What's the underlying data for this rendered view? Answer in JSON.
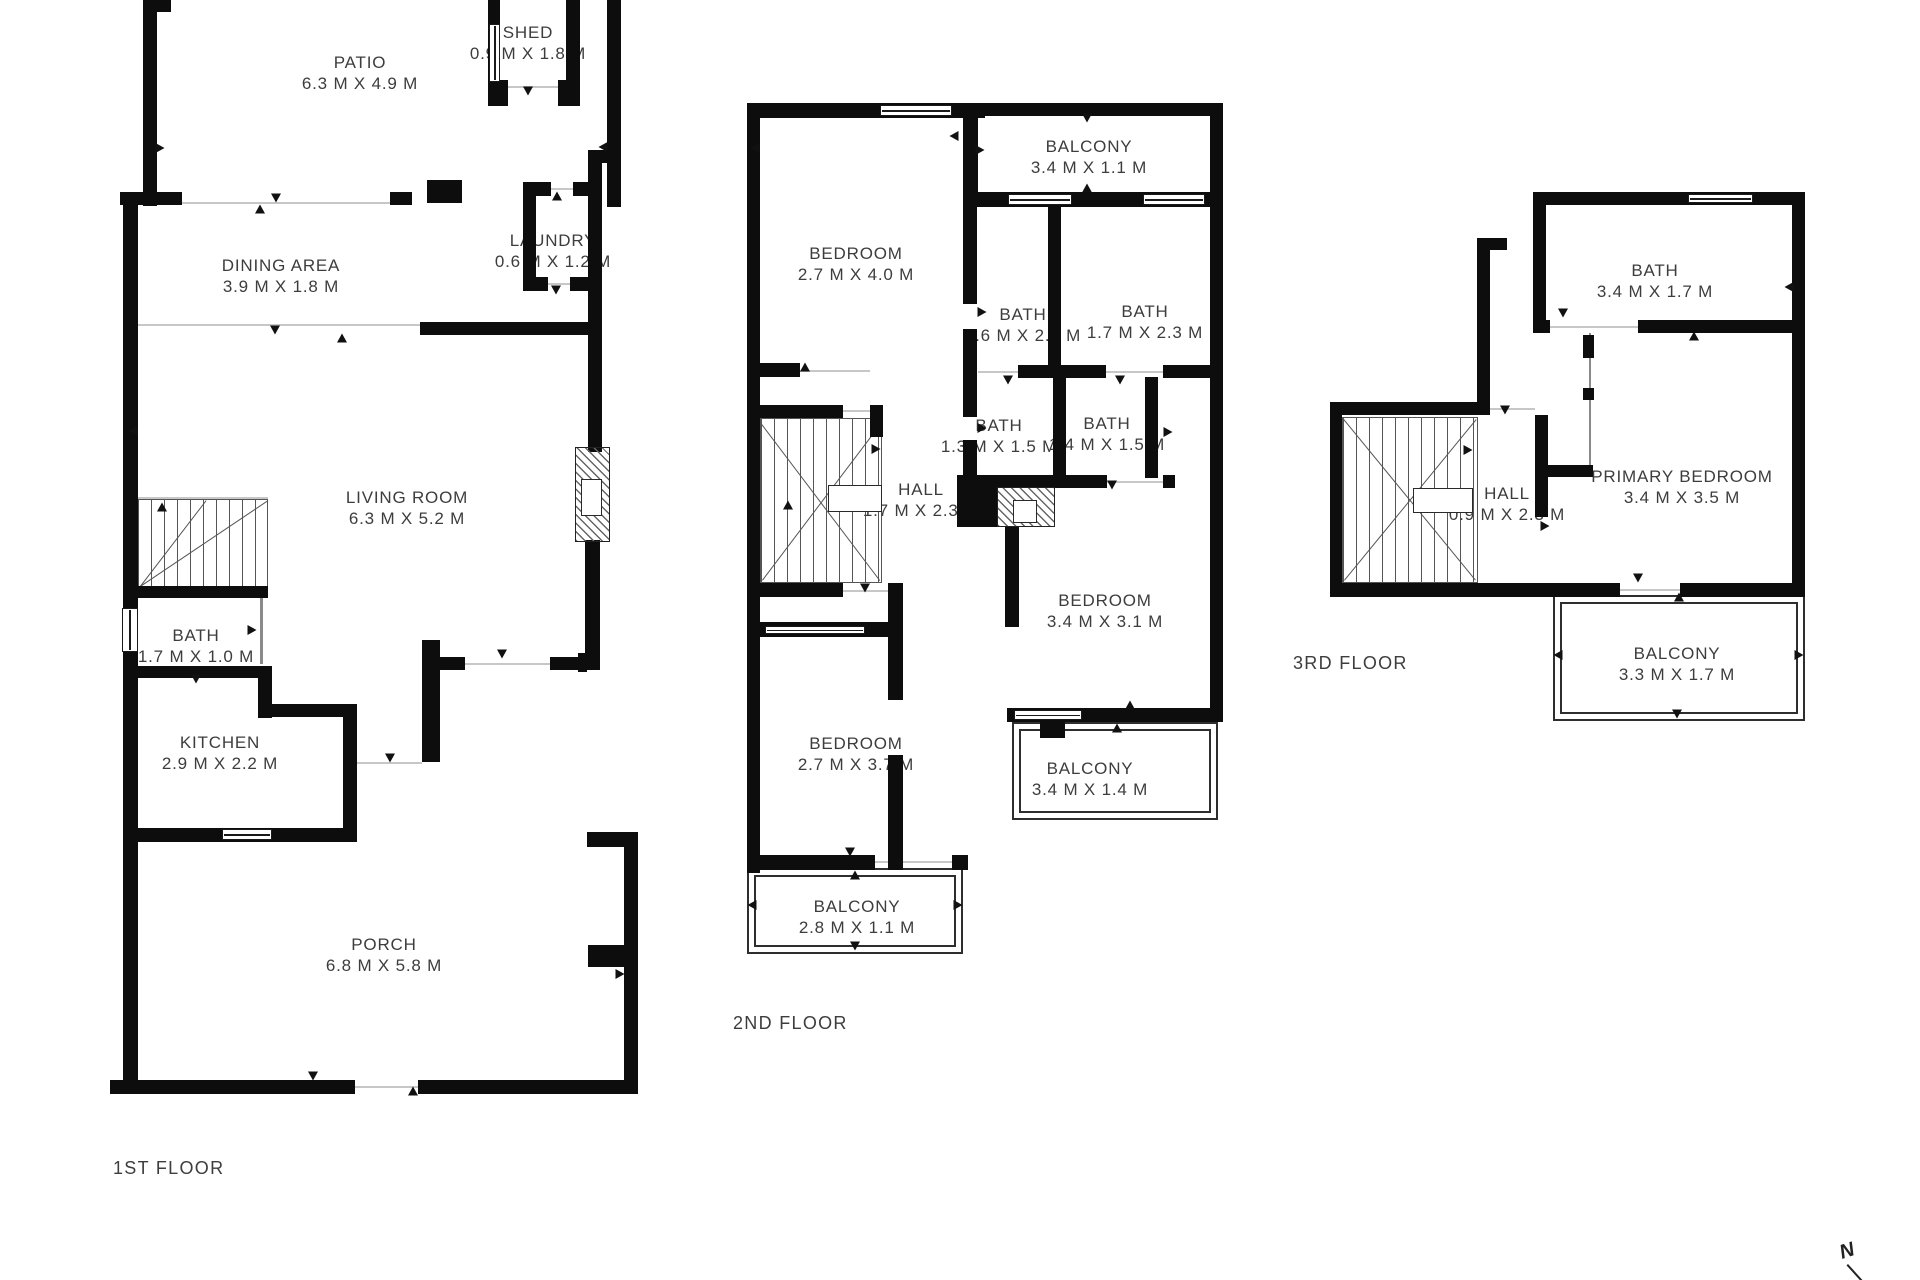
{
  "north_indicator": "N",
  "floors": [
    {
      "label": "1ST FLOOR",
      "label_pos": [
        113,
        1158
      ],
      "rooms": [
        {
          "name": "PATIO",
          "dims": "6.3 M X 4.9 M",
          "pos": [
            360,
            73
          ]
        },
        {
          "name": "SHED",
          "dims": "0.9 M X 1.8 M",
          "pos": [
            528,
            43
          ]
        },
        {
          "name": "DINING AREA",
          "dims": "3.9 M X 1.8 M",
          "pos": [
            281,
            276
          ]
        },
        {
          "name": "LAUNDRY",
          "dims": "0.6 M X 1.2 M",
          "pos": [
            553,
            251
          ]
        },
        {
          "name": "LIVING ROOM",
          "dims": "6.3 M X 5.2 M",
          "pos": [
            407,
            508
          ]
        },
        {
          "name": "BATH",
          "dims": "1.7 M X 1.0 M",
          "pos": [
            196,
            646
          ]
        },
        {
          "name": "KITCHEN",
          "dims": "2.9 M X 2.2 M",
          "pos": [
            220,
            753
          ]
        },
        {
          "name": "PORCH",
          "dims": "6.8 M X 5.8 M",
          "pos": [
            384,
            955
          ]
        }
      ],
      "walls": [
        [
          143,
          0,
          14,
          206
        ],
        [
          143,
          0,
          28,
          12
        ],
        [
          488,
          0,
          12,
          84
        ],
        [
          566,
          0,
          14,
          106
        ],
        [
          488,
          80,
          20,
          26
        ],
        [
          558,
          80,
          22,
          26
        ],
        [
          607,
          0,
          14,
          207
        ],
        [
          588,
          150,
          33,
          13
        ],
        [
          120,
          192,
          62,
          13
        ],
        [
          390,
          192,
          22,
          13
        ],
        [
          427,
          180,
          35,
          23
        ],
        [
          523,
          182,
          28,
          14
        ],
        [
          573,
          182,
          29,
          14
        ],
        [
          523,
          182,
          13,
          109
        ],
        [
          523,
          277,
          25,
          14
        ],
        [
          570,
          277,
          32,
          14
        ],
        [
          588,
          150,
          14,
          302
        ],
        [
          585,
          540,
          15,
          130
        ],
        [
          420,
          322,
          170,
          13
        ],
        [
          422,
          640,
          18,
          122
        ],
        [
          440,
          657,
          25,
          13
        ],
        [
          550,
          657,
          37,
          13
        ],
        [
          578,
          653,
          9,
          19
        ],
        [
          587,
          832,
          51,
          15
        ],
        [
          624,
          832,
          14,
          261
        ],
        [
          588,
          945,
          39,
          22
        ],
        [
          110,
          1080,
          245,
          14
        ],
        [
          418,
          1080,
          220,
          14
        ],
        [
          123,
          192,
          15,
          893
        ],
        [
          137,
          666,
          125,
          12
        ],
        [
          258,
          666,
          14,
          52
        ],
        [
          258,
          704,
          99,
          13
        ],
        [
          343,
          704,
          14,
          126
        ],
        [
          137,
          828,
          220,
          14
        ],
        [
          135,
          586,
          133,
          12
        ]
      ],
      "open_lines": [
        [
          150,
          202,
          262,
          2
        ],
        [
          138,
          324,
          284,
          2
        ],
        [
          465,
          663,
          85,
          2
        ],
        [
          548,
          188,
          27,
          2
        ],
        [
          545,
          283,
          27,
          2
        ],
        [
          355,
          1086,
          63,
          2
        ],
        [
          507,
          86,
          53,
          2
        ],
        [
          357,
          762,
          65,
          2
        ],
        [
          138,
          497,
          130,
          2
        ]
      ],
      "thin_walls": [
        [
          260,
          598,
          3,
          66
        ]
      ],
      "windows": [
        [
          489,
          24,
          11,
          58
        ],
        [
          122,
          608,
          16,
          44
        ],
        [
          222,
          829,
          50,
          11
        ]
      ],
      "hatches": [
        [
          575,
          447,
          35,
          95
        ]
      ],
      "boxes": [
        [
          581,
          479,
          21,
          37
        ]
      ],
      "frames": [],
      "treads": [
        [
          137,
          499,
          131,
          88
        ]
      ],
      "diagonals": [
        [
          140,
          586,
          268,
          500
        ],
        [
          140,
          586,
          206,
          500
        ]
      ],
      "arrows": [
        [
          276,
          198,
          "d"
        ],
        [
          260,
          209,
          "u"
        ],
        [
          275,
          330,
          "d"
        ],
        [
          342,
          338,
          "u"
        ],
        [
          557,
          196,
          "u"
        ],
        [
          556,
          290,
          "d"
        ],
        [
          528,
          91,
          "d"
        ],
        [
          502,
          654,
          "d"
        ],
        [
          603,
          147,
          "l"
        ],
        [
          160,
          148,
          "r"
        ],
        [
          162,
          507,
          "u"
        ],
        [
          252,
          630,
          "r"
        ],
        [
          196,
          679,
          "d"
        ],
        [
          390,
          758,
          "d"
        ],
        [
          313,
          1076,
          "d"
        ],
        [
          413,
          1091,
          "u"
        ],
        [
          133,
          431,
          "l"
        ],
        [
          620,
          974,
          "r"
        ]
      ]
    },
    {
      "label": "2ND FLOOR",
      "label_pos": [
        733,
        1013
      ],
      "rooms": [
        {
          "name": "BALCONY",
          "dims": "3.4 M X 1.1 M",
          "pos": [
            1089,
            157
          ]
        },
        {
          "name": "BEDROOM",
          "dims": "2.7 M X 4.0 M",
          "pos": [
            856,
            264
          ]
        },
        {
          "name": "BATH",
          "dims": "1.6 M X 2.3 M",
          "pos": [
            1023,
            325
          ]
        },
        {
          "name": "BATH",
          "dims": "1.7 M X 2.3 M",
          "pos": [
            1145,
            322
          ]
        },
        {
          "name": "BATH",
          "dims": "1.3 M X 1.5 M",
          "pos": [
            999,
            436
          ]
        },
        {
          "name": "BATH",
          "dims": "1.4 M X 1.5 M",
          "pos": [
            1107,
            434
          ]
        },
        {
          "name": "HALL",
          "dims": "1.7 M X 2.3 M",
          "pos": [
            921,
            500
          ]
        },
        {
          "name": "BEDROOM",
          "dims": "3.4 M X 3.1 M",
          "pos": [
            1105,
            611
          ]
        },
        {
          "name": "BEDROOM",
          "dims": "2.7 M X 3.7 M",
          "pos": [
            856,
            754
          ]
        },
        {
          "name": "BALCONY",
          "dims": "3.4 M X 1.4 M",
          "pos": [
            1090,
            779
          ]
        },
        {
          "name": "BALCONY",
          "dims": "2.8 M X 1.1 M",
          "pos": [
            857,
            917
          ]
        }
      ],
      "walls": [
        [
          747,
          103,
          238,
          15
        ],
        [
          985,
          103,
          238,
          13
        ],
        [
          1210,
          103,
          13,
          104
        ],
        [
          963,
          192,
          260,
          15
        ],
        [
          747,
          103,
          13,
          770
        ],
        [
          963,
          103,
          15,
          90
        ],
        [
          1048,
          207,
          13,
          160
        ],
        [
          1018,
          365,
          88,
          13
        ],
        [
          1163,
          365,
          50,
          13
        ],
        [
          963,
          192,
          14,
          112
        ],
        [
          963,
          329,
          14,
          88
        ],
        [
          963,
          440,
          14,
          42
        ],
        [
          1053,
          377,
          13,
          101
        ],
        [
          1145,
          377,
          13,
          101
        ],
        [
          1210,
          207,
          13,
          515
        ],
        [
          957,
          475,
          150,
          13
        ],
        [
          1163,
          475,
          12,
          13
        ],
        [
          957,
          480,
          40,
          47
        ],
        [
          747,
          363,
          53,
          14
        ],
        [
          870,
          405,
          13,
          32
        ],
        [
          747,
          405,
          96,
          13
        ],
        [
          747,
          583,
          96,
          14
        ],
        [
          888,
          583,
          15,
          117
        ],
        [
          888,
          755,
          15,
          115
        ],
        [
          1005,
          527,
          14,
          100
        ],
        [
          755,
          622,
          135,
          15
        ],
        [
          1007,
          708,
          210,
          14
        ],
        [
          1040,
          722,
          25,
          16
        ],
        [
          747,
          855,
          128,
          15
        ],
        [
          952,
          855,
          16,
          15
        ]
      ],
      "open_lines": [
        [
          800,
          370,
          70,
          2
        ],
        [
          843,
          410,
          27,
          2
        ],
        [
          978,
          371,
          40,
          2
        ],
        [
          1106,
          371,
          57,
          2
        ],
        [
          1107,
          481,
          56,
          2
        ],
        [
          875,
          861,
          77,
          2
        ],
        [
          843,
          590,
          45,
          2
        ],
        [
          1090,
          716,
          45,
          2
        ]
      ],
      "thin_walls": [],
      "windows": [
        [
          880,
          105,
          72,
          11
        ],
        [
          1008,
          194,
          64,
          11
        ],
        [
          1143,
          194,
          62,
          11
        ],
        [
          765,
          626,
          100,
          8
        ],
        [
          1014,
          710,
          68,
          10
        ]
      ],
      "hatches": [
        [
          997,
          487,
          58,
          40
        ]
      ],
      "boxes": [
        [
          1013,
          500,
          24,
          23
        ],
        [
          828,
          485,
          54,
          27
        ]
      ],
      "frames": [
        [
          1012,
          722,
          206,
          98
        ],
        [
          1019,
          729,
          192,
          84
        ],
        [
          747,
          868,
          216,
          86
        ],
        [
          754,
          875,
          202,
          72
        ]
      ],
      "treads": [
        [
          760,
          418,
          122,
          165
        ]
      ],
      "diagonals": [
        [
          762,
          580,
          880,
          424
        ],
        [
          762,
          424,
          880,
          580
        ]
      ],
      "arrows": [
        [
          1087,
          118,
          "d"
        ],
        [
          1087,
          188,
          "u"
        ],
        [
          954,
          136,
          "l"
        ],
        [
          980,
          150,
          "r"
        ],
        [
          805,
          367,
          "u"
        ],
        [
          1008,
          380,
          "d"
        ],
        [
          1120,
          380,
          "d"
        ],
        [
          982,
          312,
          "r"
        ],
        [
          982,
          428,
          "r"
        ],
        [
          1168,
          432,
          "r"
        ],
        [
          1112,
          485,
          "d"
        ],
        [
          876,
          449,
          "r"
        ],
        [
          788,
          505,
          "u"
        ],
        [
          865,
          588,
          "d"
        ],
        [
          850,
          852,
          "d"
        ],
        [
          855,
          875,
          "u"
        ],
        [
          1117,
          728,
          "u"
        ],
        [
          1130,
          705,
          "u"
        ],
        [
          752,
          905,
          "l"
        ],
        [
          958,
          905,
          "r"
        ],
        [
          855,
          946,
          "d"
        ],
        [
          755,
          148,
          "l"
        ]
      ]
    },
    {
      "label": "3RD FLOOR",
      "label_pos": [
        1293,
        653
      ],
      "rooms": [
        {
          "name": "BATH",
          "dims": "3.4 M X 1.7 M",
          "pos": [
            1655,
            281
          ]
        },
        {
          "name": "PRIMARY BEDROOM",
          "dims": "3.4 M X 3.5 M",
          "pos": [
            1682,
            487
          ]
        },
        {
          "name": "HALL",
          "dims": "0.9 M X 2.3 M",
          "pos": [
            1507,
            504
          ]
        },
        {
          "name": "BALCONY",
          "dims": "3.3 M X 1.7 M",
          "pos": [
            1677,
            664
          ]
        }
      ],
      "walls": [
        [
          1533,
          192,
          272,
          13
        ],
        [
          1792,
          192,
          13,
          403
        ],
        [
          1533,
          192,
          13,
          141
        ],
        [
          1533,
          320,
          17,
          13
        ],
        [
          1638,
          320,
          167,
          13
        ],
        [
          1477,
          238,
          30,
          12
        ],
        [
          1477,
          238,
          13,
          177
        ],
        [
          1330,
          402,
          158,
          13
        ],
        [
          1330,
          402,
          12,
          193
        ],
        [
          1330,
          583,
          215,
          14
        ],
        [
          1543,
          583,
          77,
          14
        ],
        [
          1680,
          583,
          125,
          14
        ],
        [
          1535,
          415,
          13,
          102
        ],
        [
          1543,
          465,
          50,
          12
        ],
        [
          1583,
          335,
          11,
          23
        ],
        [
          1583,
          388,
          11,
          12
        ]
      ],
      "open_lines": [
        [
          1550,
          326,
          88,
          2
        ],
        [
          1620,
          589,
          60,
          2
        ],
        [
          1488,
          408,
          47,
          2
        ]
      ],
      "thin_walls": [
        [
          1589,
          333,
          2,
          132
        ]
      ],
      "windows": [
        [
          1688,
          194,
          65,
          9
        ]
      ],
      "hatches": [],
      "boxes": [
        [
          1413,
          488,
          60,
          25
        ]
      ],
      "frames": [
        [
          1553,
          595,
          252,
          126
        ],
        [
          1560,
          602,
          238,
          112
        ]
      ],
      "treads": [
        [
          1342,
          417,
          136,
          166
        ]
      ],
      "diagonals": [
        [
          1344,
          580,
          1476,
          419
        ],
        [
          1344,
          419,
          1476,
          580
        ]
      ],
      "arrows": [
        [
          1563,
          313,
          "d"
        ],
        [
          1694,
          336,
          "u"
        ],
        [
          1638,
          578,
          "d"
        ],
        [
          1679,
          597,
          "u"
        ],
        [
          1558,
          655,
          "l"
        ],
        [
          1799,
          655,
          "r"
        ],
        [
          1677,
          714,
          "d"
        ],
        [
          1545,
          526,
          "r"
        ],
        [
          1468,
          450,
          "r"
        ],
        [
          1505,
          410,
          "d"
        ],
        [
          1789,
          287,
          "l"
        ]
      ]
    }
  ]
}
